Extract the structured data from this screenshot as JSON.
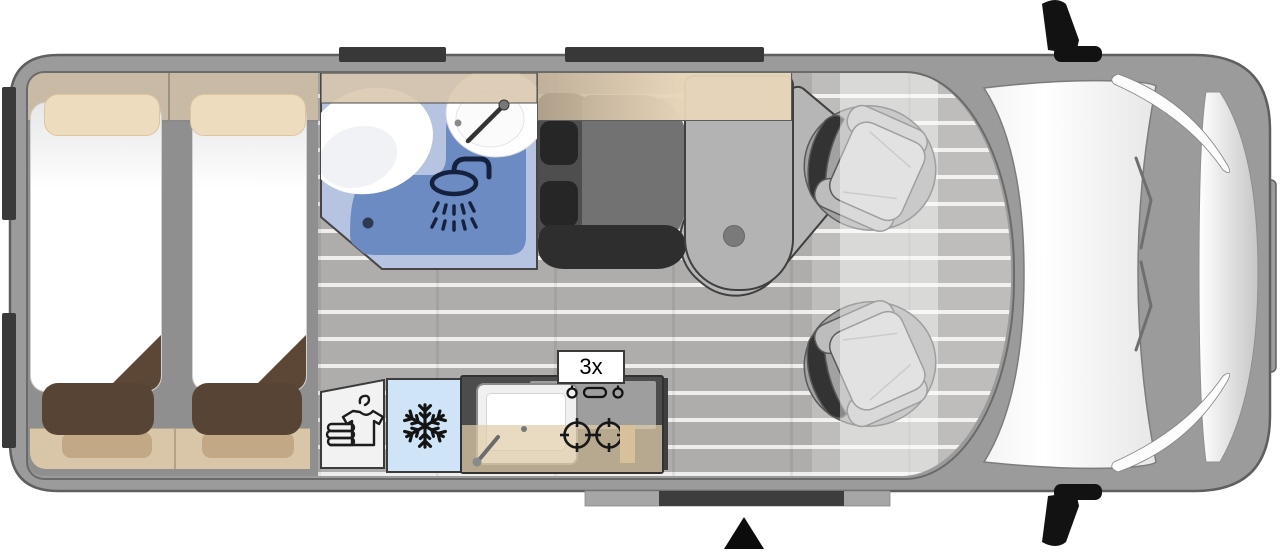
{
  "diagram": {
    "type": "campervan-floorplan-top-view",
    "labels": {
      "gas_burners": "3x"
    },
    "regions": [
      "rear-twin-bed-left",
      "rear-twin-bed-right",
      "bathroom-shower-toilet-sink",
      "wardrobe",
      "fridge",
      "kitchen-sink-two-burner-stove",
      "dinette-bench-seat",
      "pedestal-swivel-table",
      "cab-swivel-seat-top",
      "cab-swivel-seat-bottom",
      "sliding-door",
      "rear-doors",
      "windshield",
      "side-mirrors",
      "entrance-marker"
    ],
    "icons": [
      "shower-icon",
      "faucet-icon",
      "snowflake-icon",
      "wardrobe-clothes-icon",
      "burner-icon",
      "stove-knobs-icon",
      "drain-icon",
      "entrance-triangle-icon",
      "side-mirror-icon"
    ],
    "colors": {
      "van_body": "#9b9b9b",
      "interior_wall": "#8f8f8f",
      "floor_planks": "#aeadab",
      "bathroom_floor": "#b6c3e1",
      "shower_tray": "#6d8bc3",
      "fridge_blue": "#cfe4f6",
      "overhead_shelf": "#c8baa4",
      "countertop_beige": "#e0cdaa",
      "bench_beige": "#d9c6a9",
      "cushion_brown": "#574434",
      "mattress_white": "#ffffff",
      "seat_dark_gray": "#4e4e4e",
      "table_gray": "#b3b3b3",
      "marker_dark": "#3a3a3a"
    }
  }
}
